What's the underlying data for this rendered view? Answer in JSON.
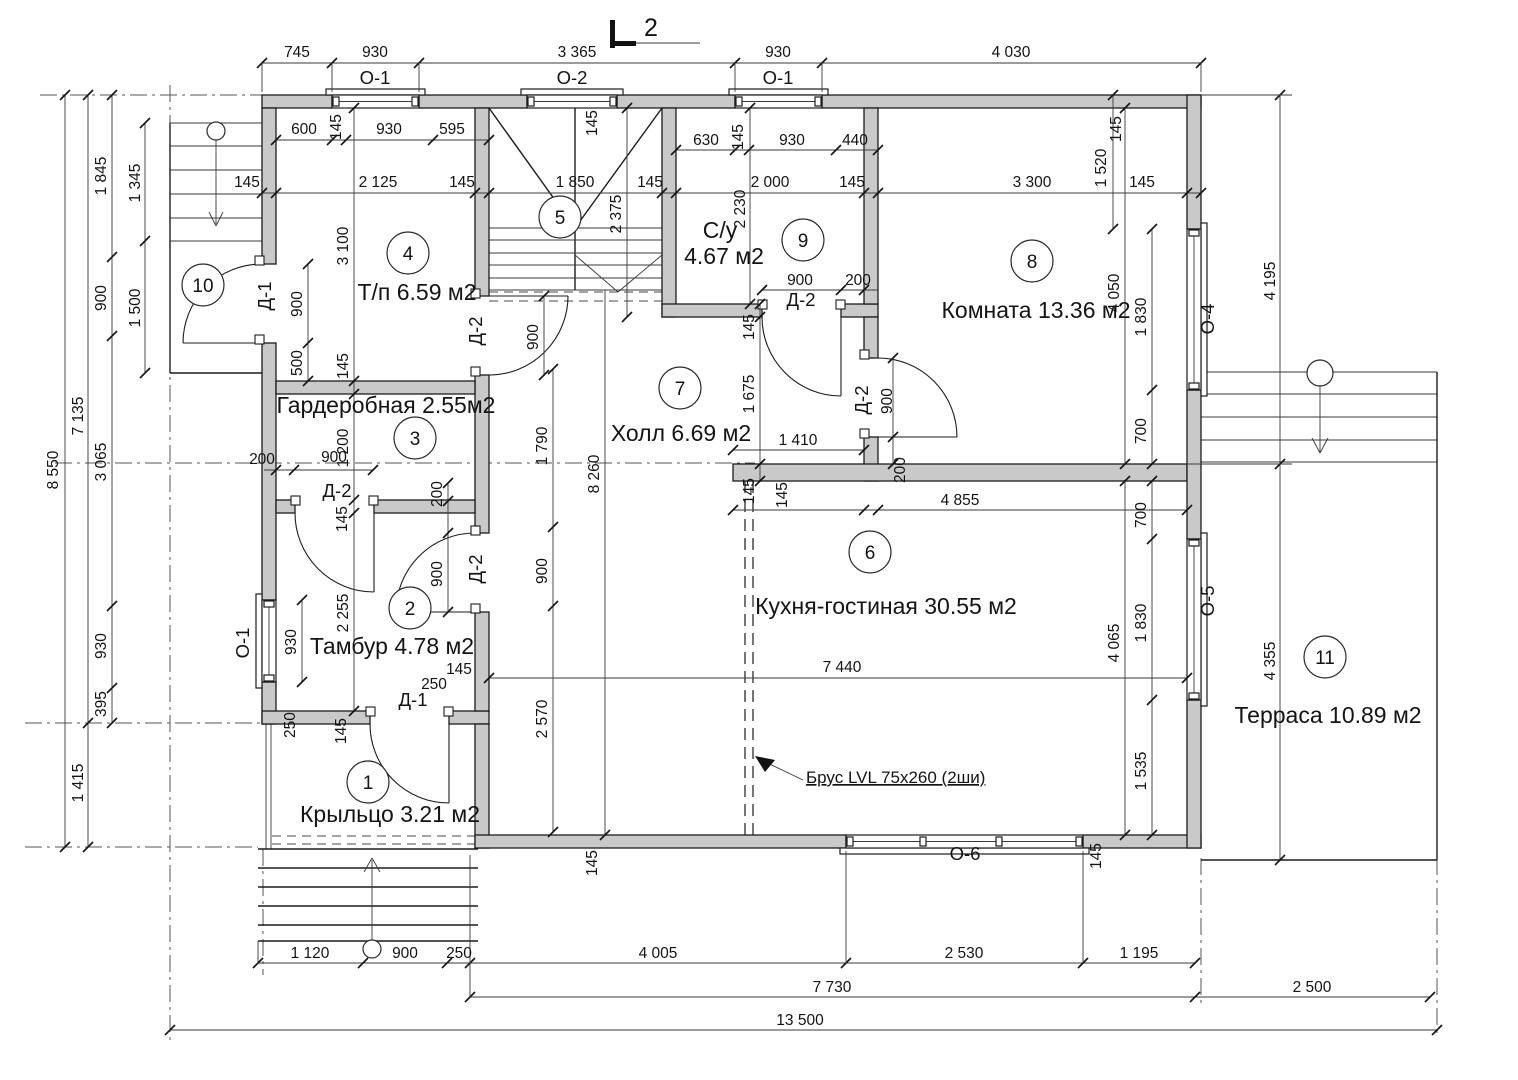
{
  "drawing": {
    "section_label": "2",
    "beam_note": "Брус LVL 75x260 (2ши)"
  },
  "rooms": {
    "r1": {
      "num": "1",
      "label": "Крыльцо 3.21 м2"
    },
    "r2": {
      "num": "2",
      "label": "Тамбур 4.78 м2"
    },
    "r3": {
      "num": "3",
      "label": "Гардеробная 2.55м2"
    },
    "r4": {
      "num": "4",
      "label": "Т/п 6.59 м2"
    },
    "r5": {
      "num": "5"
    },
    "r6": {
      "num": "6",
      "label": "Кухня-гостиная 30.55 м2"
    },
    "r7": {
      "num": "7",
      "label": "Холл 6.69 м2"
    },
    "r8": {
      "num": "8",
      "label": "Комната 13.36 м2"
    },
    "r9": {
      "num": "9",
      "label_line1": "С/у",
      "label_line2": "4.67 м2"
    },
    "r10": {
      "num": "10"
    },
    "r11": {
      "num": "11",
      "label": "Терраса 10.89 м2"
    }
  },
  "openings": {
    "windows": {
      "o1_top": "О-1",
      "o2_top": "О-2",
      "o1_top2": "О-1",
      "o1_left": "О-1",
      "o4": "О-4",
      "o5": "О-5",
      "o6": "О-6"
    },
    "doors": {
      "d1_room10": "Д-1",
      "d1_porch": "Д-1",
      "d2_tp": "Д-2",
      "d2_gard": "Д-2",
      "d2_tambur": "Д-2",
      "d2_su": "Д-2",
      "d2_room8": "Д-2"
    }
  },
  "dims": {
    "top_745": "745",
    "top_930a": "930",
    "top_3365": "3 365",
    "top_930b": "930",
    "top_4030": "4 030",
    "tpw_600": "600",
    "tpw_145": "145",
    "tpw_930": "930",
    "tpw_595": "595",
    "suw_630": "630",
    "suw_145": "145",
    "suw_930": "930",
    "suw_440": "440",
    "main_145l": "145",
    "main_2125": "2 125",
    "main_145a": "145",
    "main_1850": "1 850",
    "main_145b": "145",
    "main_2000": "2 000",
    "main_145c": "145",
    "main_3300": "3 300",
    "main_1520": "1 520",
    "main_145d": "145",
    "left_8550": "8 550",
    "left_7135": "7 135",
    "left_1415": "1 415",
    "left_1845": "1 845",
    "left_900": "900",
    "left_3065": "3 065",
    "left_930": "930",
    "left_395": "395",
    "left_1345": "1 345",
    "left_1500": "1 500",
    "tp_3100": "3 100",
    "tp_900": "900",
    "tp_500": "500",
    "tp_145": "145",
    "gard_200": "200",
    "gard_900": "900",
    "gard_1200": "1 200",
    "gard_145": "145",
    "gard_200b": "200",
    "gard_900b": "900",
    "tam_2255": "2 255",
    "tam_930": "930",
    "tam_145": "145",
    "tam_250": "250",
    "porch_250": "250",
    "porch_145": "145",
    "stair_2375": "2 375",
    "stair_900": "900",
    "jamb_o2": "145",
    "wall_right_145": "145",
    "su_2230": "2 230",
    "su_900": "900",
    "su_200": "200",
    "su_145": "145",
    "su_1675": "1 675",
    "hall_8260": "8 260",
    "hall_1790": "1 790",
    "hall_900": "900",
    "hall_2570": "2 570",
    "hall_1410": "1 410",
    "hall_145": "145",
    "hall_200": "200",
    "room8_900": "900",
    "room8_4050": "4 050",
    "room8_1830": "1 830",
    "room8_700": "700",
    "kit_4855": "4 855",
    "kit_145": "145",
    "kit_7440": "7 440",
    "kit_700": "700",
    "kit_1830": "1 830",
    "kit_1535": "1 535",
    "kit_4065": "4 065",
    "kit_145b": "145",
    "kit_145c": "145",
    "right_4195": "4 195",
    "right_4355": "4 355",
    "bot_1120": "1 120",
    "bot_900": "900",
    "bot_250": "250",
    "bot_4005": "4 005",
    "bot_2530": "2 530",
    "bot_1195": "1 195",
    "bot_7730": "7 730",
    "bot_2500": "2 500",
    "bot_13500": "13 500"
  }
}
